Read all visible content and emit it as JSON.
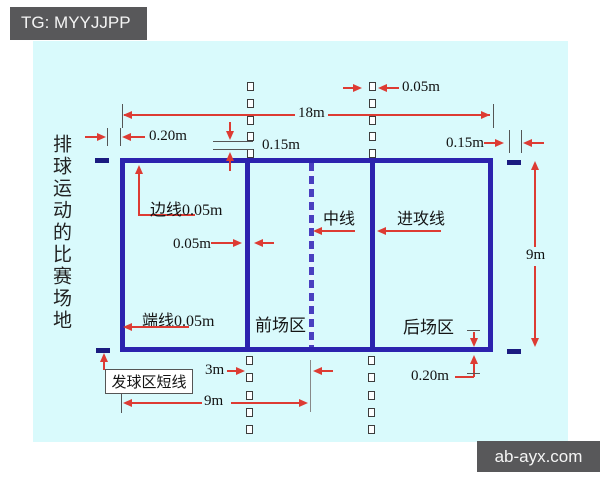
{
  "overlay": {
    "tag_label": "TG: MYYJJPP",
    "watermark": "ab-ayx.com"
  },
  "diagram": {
    "side_title": "排球运动的比赛场地",
    "labels": {
      "sideline": "边线0.05m",
      "center_line": "中线",
      "attack_line": "进攻线",
      "end_line": "端线0.05m",
      "front_zone": "前场区",
      "back_zone": "后场区",
      "service_short_line": "发球区短线"
    },
    "dimensions": {
      "court_length": "18m",
      "service_mark_offset": "0.20m",
      "broken_dash_length": "0.15m",
      "broken_line_width": "0.05m",
      "service_mark_length": "0.15m",
      "court_width": "9m",
      "attack_line_width": "0.05m",
      "attack_zone_depth": "3m",
      "half_court_length": "9m",
      "back_mark_offset": "0.20m"
    },
    "colors": {
      "background": "#d9fafc",
      "court_line": "#2c22ae",
      "dimension_arrow": "#dd3b33",
      "label_text": "#141414",
      "overlay_box": "#58585a"
    }
  }
}
